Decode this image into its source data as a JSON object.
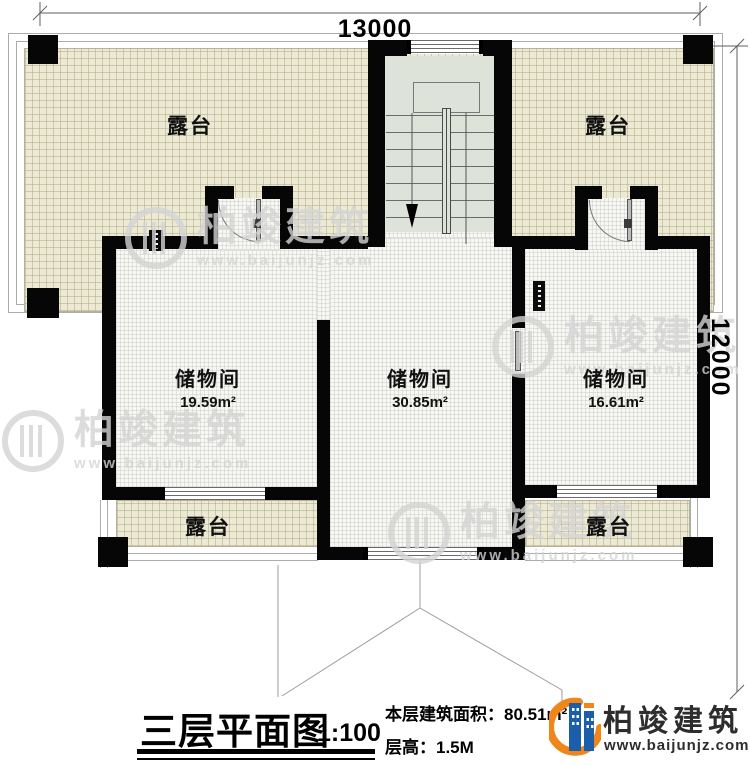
{
  "drawing": {
    "dimensions": {
      "top": "13000",
      "right": "12000"
    },
    "terraces": [
      "露台",
      "露台",
      "露台",
      "露台"
    ],
    "rooms": [
      {
        "name": "储物间",
        "area": "19.59m²"
      },
      {
        "name": "储物间",
        "area": "30.85m²"
      },
      {
        "name": "储物间",
        "area": "16.61m²"
      }
    ]
  },
  "title_block": {
    "title": "三层平面图",
    "scale": "1:100",
    "area_label": "本层建筑面积：",
    "area_value": "80.51m²",
    "height_label": "层高：",
    "height_value": "1.5M"
  },
  "brand": {
    "name": "柏竣建筑",
    "url": "www.baijunjz.com"
  },
  "watermark": {
    "name": "柏竣建筑",
    "url": "www.baijunjz.com"
  },
  "colors": {
    "wall": "#060606",
    "terrace_fill": "#ECE9D5",
    "stair_fill": "#DEE3D9",
    "brand_blue": "#1B5EA9",
    "brand_orange": "#F08519",
    "watermark_gray": "#D4D4D4"
  },
  "icons": {
    "brand_logo": "building-swoosh-icon",
    "watermark_logo": "building-swoosh-icon"
  }
}
